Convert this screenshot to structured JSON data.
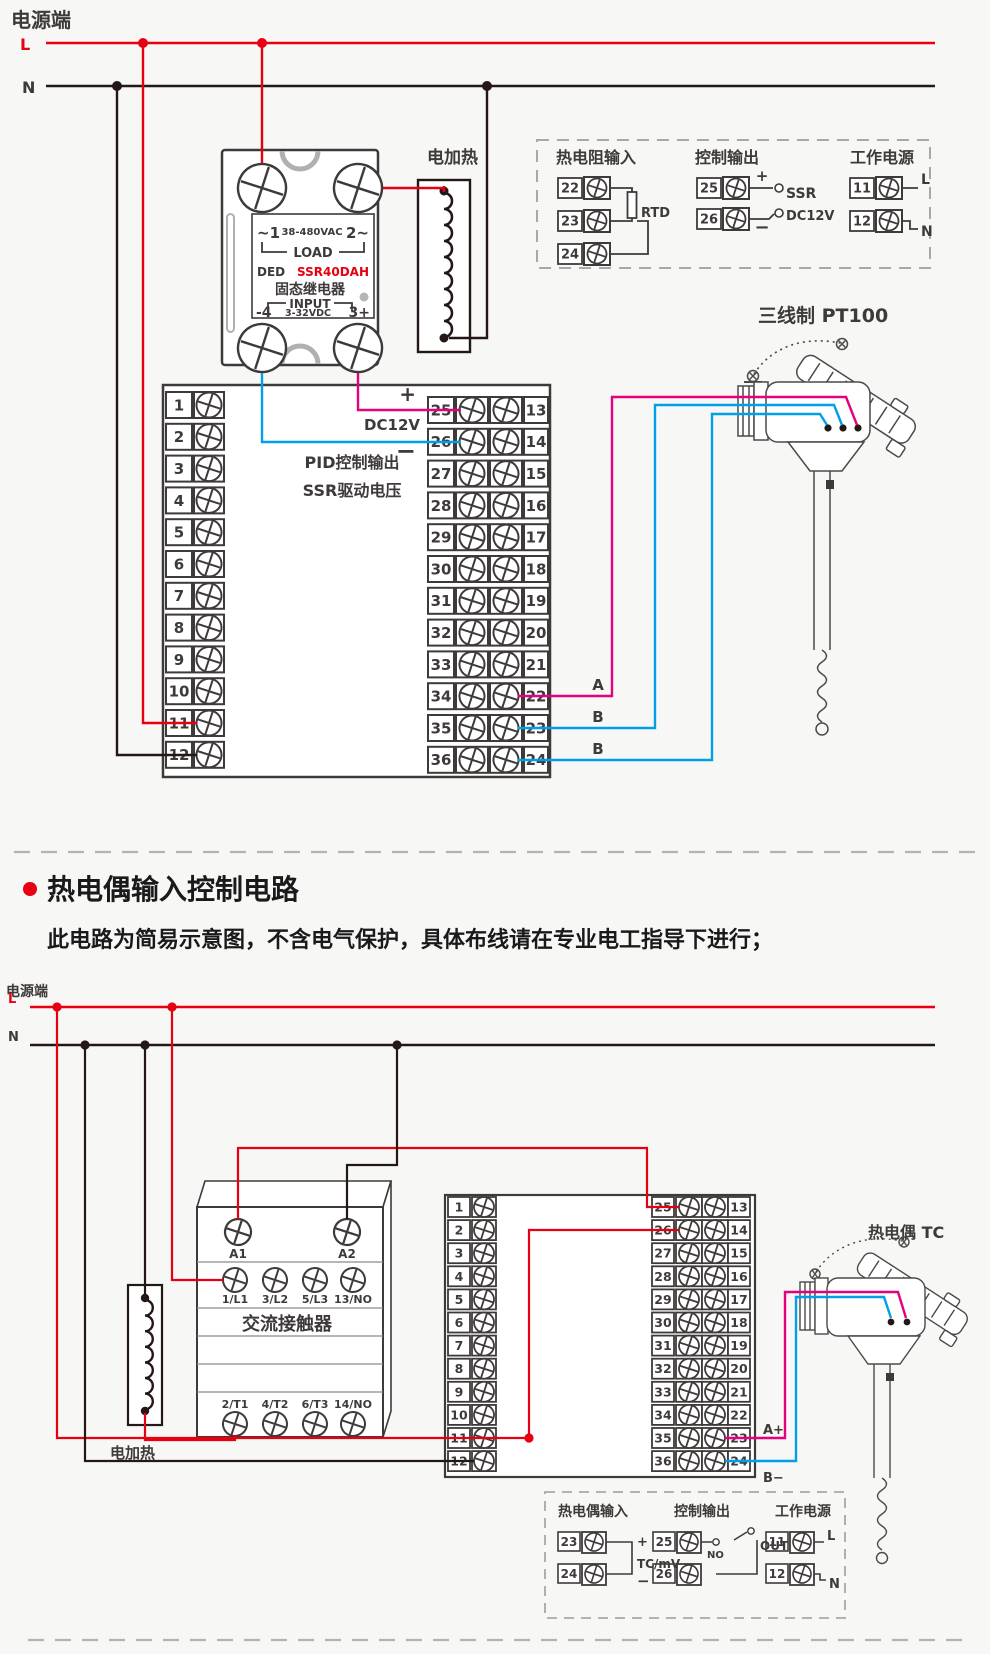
{
  "colors": {
    "background": "#f7f7f5",
    "line_red": "#e60012",
    "wire_black": "#231815",
    "wire_magenta": "#e4007f",
    "wire_cyan": "#00a0e9",
    "dark": "#3e3a39",
    "gray": "#9e9e9f",
    "model_red": "#e60012"
  },
  "top_circuit": {
    "power_label": "电源端",
    "l_label": "L",
    "n_label": "N",
    "ssr": {
      "line1_left": "~1",
      "line1_mid": "38-480VAC",
      "line1_right": "2~",
      "load_label": "LOAD",
      "brand": "DED",
      "model": "SSR40DAH",
      "name": "固态继电器",
      "input_label": "INPUT",
      "in_left": "-4",
      "in_mid": "3-32VDC",
      "in_right": "3+"
    },
    "heater_label": "电加热",
    "guide": {
      "rtd_group": {
        "title": "热电阻输入",
        "terminals": [
          "22",
          "23",
          "24"
        ],
        "rtd_label": "RTD"
      },
      "out_group": {
        "title": "控制输出",
        "terminals": [
          "25",
          "26"
        ],
        "plus": "+",
        "minus": "−",
        "ssr_label": "SSR",
        "dc12v_label": "DC12V"
      },
      "pwr_group": {
        "title": "工作电源",
        "terminals": [
          "11",
          "12"
        ],
        "l": "L",
        "n": "N"
      }
    },
    "sensor_label": "三线制 PT100",
    "block": {
      "left": [
        "1",
        "2",
        "3",
        "4",
        "5",
        "6",
        "7",
        "8",
        "9",
        "10",
        "11",
        "12"
      ],
      "mid": [
        "25",
        "26",
        "27",
        "28",
        "29",
        "30",
        "31",
        "32",
        "33",
        "34",
        "35",
        "36"
      ],
      "right": [
        "13",
        "14",
        "15",
        "16",
        "17",
        "18",
        "19",
        "20",
        "21",
        "22",
        "23",
        "24"
      ],
      "plus": "+",
      "dc12v": "DC12V",
      "minus": "−",
      "pid_line1": "PID控制输出",
      "pid_line2": "SSR驱动电压",
      "out_a": "A",
      "out_b1": "B",
      "out_b2": "B"
    }
  },
  "section2": {
    "title": "热电偶输入控制电路",
    "subtitle": "此电路为简易示意图，不含电气保护，具体布线请在专业电工指导下进行；"
  },
  "bottom_circuit": {
    "power_label": "电源端",
    "l_label": "L",
    "n_label": "N",
    "contactor": {
      "a1": "A1",
      "a2": "A2",
      "top_terms": [
        "1/L1",
        "3/L2",
        "5/L3",
        "13/NO"
      ],
      "name": "交流接触器",
      "bottom_terms": [
        "2/T1",
        "4/T2",
        "6/T3",
        "14/NO"
      ]
    },
    "heater_label": "电加热",
    "sensor_label": "热电偶 TC",
    "block": {
      "left": [
        "1",
        "2",
        "3",
        "4",
        "5",
        "6",
        "7",
        "8",
        "9",
        "10",
        "11",
        "12"
      ],
      "mid": [
        "25",
        "26",
        "27",
        "28",
        "29",
        "30",
        "31",
        "32",
        "33",
        "34",
        "35",
        "36"
      ],
      "right": [
        "13",
        "14",
        "15",
        "16",
        "17",
        "18",
        "19",
        "20",
        "21",
        "22",
        "23",
        "24"
      ],
      "a_plus": "A+",
      "b_minus": "B−"
    },
    "guide": {
      "tc_group": {
        "title": "热电偶输入",
        "terminals": [
          "23",
          "24"
        ],
        "plus": "+",
        "minus": "−",
        "tc_label": "TC/mV"
      },
      "out_group": {
        "title": "控制输出",
        "terminals": [
          "25",
          "26"
        ],
        "no_label": "NO",
        "out_label": "OUT"
      },
      "pwr_group": {
        "title": "工作电源",
        "terminals": [
          "11",
          "12"
        ],
        "l": "L",
        "n": "N"
      }
    }
  }
}
